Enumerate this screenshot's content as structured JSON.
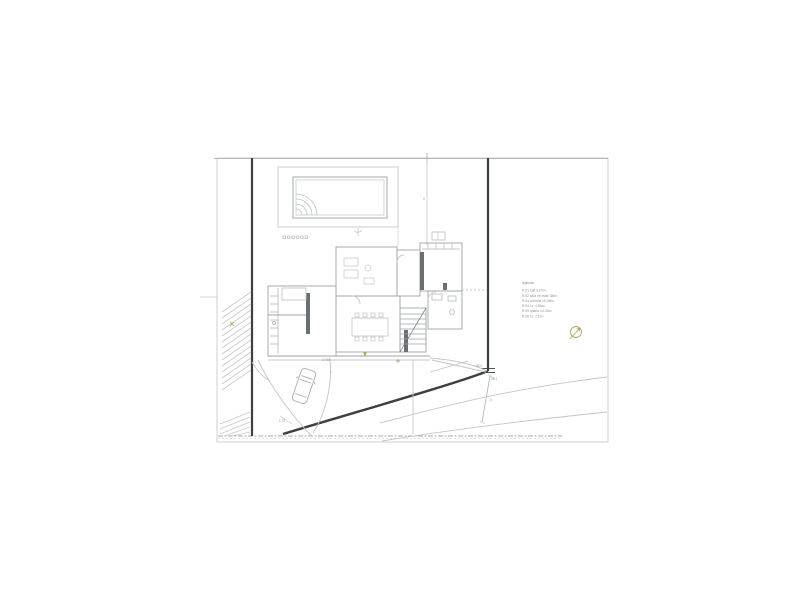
{
  "drawing": {
    "type": "architectural-site-plan",
    "colors": {
      "paper": "#ffffff",
      "sheet_border": "#cdd0d2",
      "thin_line": "#c3c6c8",
      "medium_line": "#9ea3a7",
      "boundary_dark": "#3b4043",
      "wall_poche": "#6a6f73",
      "accent_olive": "#b0a264",
      "text_gray": "#8d9296"
    }
  },
  "legend": {
    "title": "legenda",
    "items": [
      "R.01 hall 3,27m²",
      "R.02 sala de estar 38m²",
      "R.03 cozinha 15,06m²",
      "R.04 i.s. 4,85m²",
      "R.05 quarto 14,32m²",
      "R.06 i.s. 7,1m²"
    ]
  },
  "annotations": {
    "a_dim_pool": {
      "text": "9"
    },
    "a_radius": {
      "text": "7"
    },
    "a_len": {
      "text": "17.08"
    },
    "a_step": {
      "text": "1.70"
    },
    "a_lvl1": {
      "text": "+38.4"
    },
    "a_lvl2": {
      "text": "38.1"
    },
    "a_seg": {
      "text": "5"
    }
  },
  "icons": {
    "compass": "north-arrow-compass"
  }
}
